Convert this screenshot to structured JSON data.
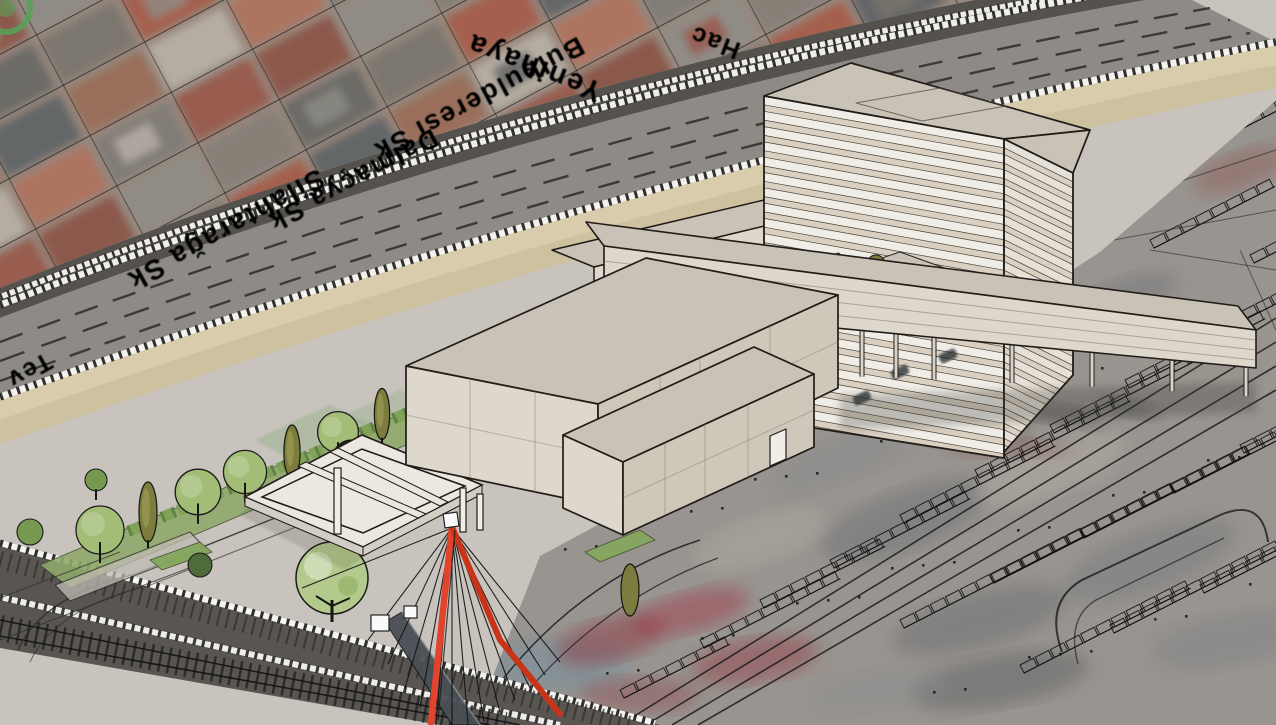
{
  "app": {
    "type": "3d-architectural-model-viewport",
    "title": "Architectural massing model over aerial site map"
  },
  "map": {
    "street_labels": [
      {
        "text": "Hac"
      },
      {
        "text": "Yenihaya"
      },
      {
        "text": "Bulbulderesi Sk"
      },
      {
        "text": "Dalmaçya Sk"
      },
      {
        "text": "Silahtarağa Sk"
      },
      {
        "text": "Tev"
      }
    ],
    "label_color": "#f5f5f3",
    "label_outline_color": "#141414"
  },
  "scene": {
    "buildings": [
      "striped-tower",
      "podium-wing",
      "elevated-bar-on-pilotis",
      "gallery-box-west",
      "gallery-box-south"
    ],
    "landscape": [
      "tree-row",
      "hedge",
      "pergola-courtyard",
      "plaza",
      "lawn-strips"
    ],
    "infrastructure": [
      "railway-viaduct",
      "railway-tracks",
      "service-road",
      "red-cable-mast"
    ]
  },
  "palette": {
    "outline": "#211c17",
    "face_top": "#c9c2b7",
    "face_sw": "#ded7cb",
    "face_se": "#cec7ba",
    "stripe_light": "#f0ede7",
    "stripe_dark": "#d9d0c2",
    "tower_line": "#4a4236",
    "ground": "#c8c3bc",
    "corridor_dark": "#55524d",
    "deck": "#8e8b86",
    "tan1": "#cdc19f",
    "tan2": "#d9cdad",
    "rail_white": "#f5f4f0",
    "tie_dark": "#1f1e1c",
    "lane_dash": "#33312e",
    "lawn": "#83a75d",
    "hedge1": "#7da155",
    "hedge2": "#5d8040",
    "tree1": "#a3bd77",
    "tree2": "#8fae5f",
    "tree3": "#c3d6a0",
    "poplar": "#7c7c3f",
    "tree_dark": "#232b18",
    "trunk": "#161616",
    "pergola_top": "#ebe8e1",
    "pergola_side": "#d2cec5",
    "mast_red": "#e2432c",
    "mast_red2": "#c93318",
    "cable": "#101010",
    "deck_dark": "#4a4f55",
    "sat_base": "#97897e",
    "cad_base": "#98948f",
    "cad_line": "#0e0e0e",
    "shadow": "#3c3a36",
    "sat_colors": [
      "#9a6b57",
      "#8a5245",
      "#a65b48",
      "#7e7b76",
      "#676663",
      "#b9b2a7",
      "#8e8c86",
      "#5e6264",
      "#99564a",
      "#7a746c",
      "#b0715c",
      "#847e76"
    ]
  }
}
